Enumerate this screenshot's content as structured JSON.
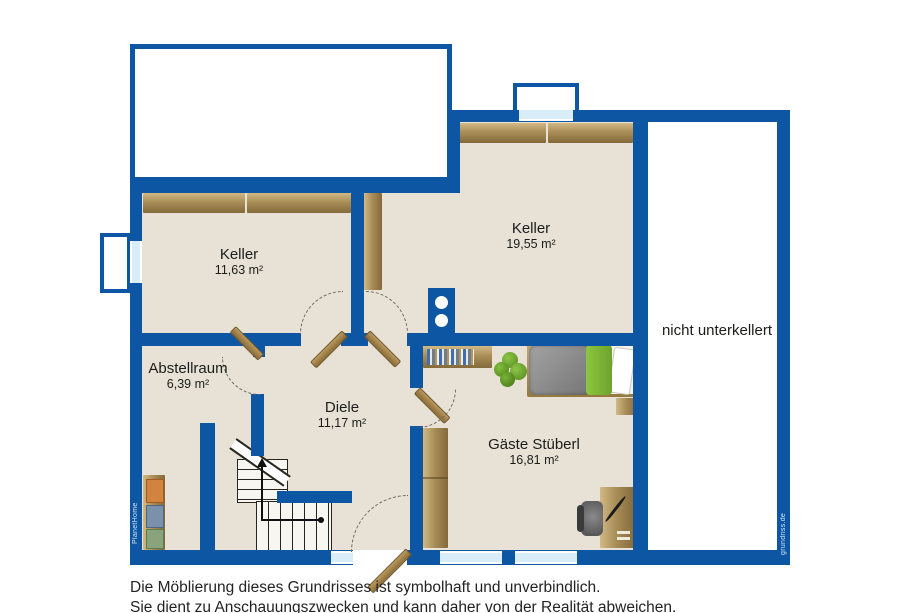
{
  "floor_plan": {
    "rooms": [
      {
        "name": "Keller",
        "area": "11,63 m²"
      },
      {
        "name": "Keller",
        "area": "19,55 m²"
      },
      {
        "name": "Abstellraum",
        "area": "6,39 m²"
      },
      {
        "name": "Diele",
        "area": "11,17 m²"
      },
      {
        "name": "Gäste Stüberl",
        "area": "16,81 m²"
      }
    ],
    "no_basement_label": "nicht unterkellert",
    "watermark_left": "PlanetHome",
    "watermark_right": "grundriss.de",
    "disclaimer_line1": "Die Möblierung dieses Grundrisses ist symbolhaft und unverbindlich.",
    "disclaimer_line2": "Sie dient zu Anschauungszwecken und kann daher von der Realität abweichen.",
    "colors": {
      "wall_blue": "#0d56a4",
      "floor_beige": "#e7e2d5",
      "wood_tan": "#a98e58",
      "window_glass": "#d9edf8",
      "bed_duvet_gray": "#8d8d8d",
      "bed_blanket_green": "#7fb93c",
      "plant_green": "#6fae2f"
    }
  }
}
